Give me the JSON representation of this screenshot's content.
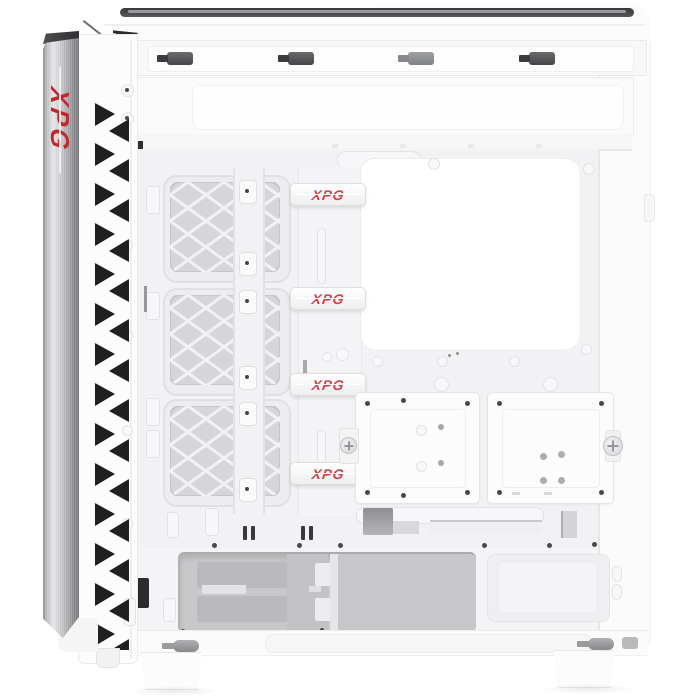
{
  "scene": {
    "type": "product-photo",
    "subject": "XPG white mid-tower PC case, open side view showing interior",
    "background": "#FFFFFF"
  },
  "brand": {
    "name": "XPG"
  },
  "front_panel_logo": {
    "text": "XPG"
  },
  "cable_straps": [
    {
      "label": "XPG"
    },
    {
      "label": "XPG"
    },
    {
      "label": "XPG"
    },
    {
      "label": "XPG"
    }
  ],
  "colors": {
    "accent_red": "#C4262E",
    "strap_red": "#CC4449",
    "body_white": "#F2F2F4",
    "panel_white": "#FBFBFC",
    "mesh_gray": "#D6D6D8",
    "mesh_line": "#F2F2F4",
    "bay_gray": "#C8C8CA",
    "drive_gray": "#BABABC",
    "latch_dark": "#535355",
    "vent_dark": "#202022",
    "aluminum_light": "#E4E4E6",
    "aluminum_dark": "#737376",
    "seam_gray": "#E6E6E8",
    "screw_dark": "#48484A"
  }
}
